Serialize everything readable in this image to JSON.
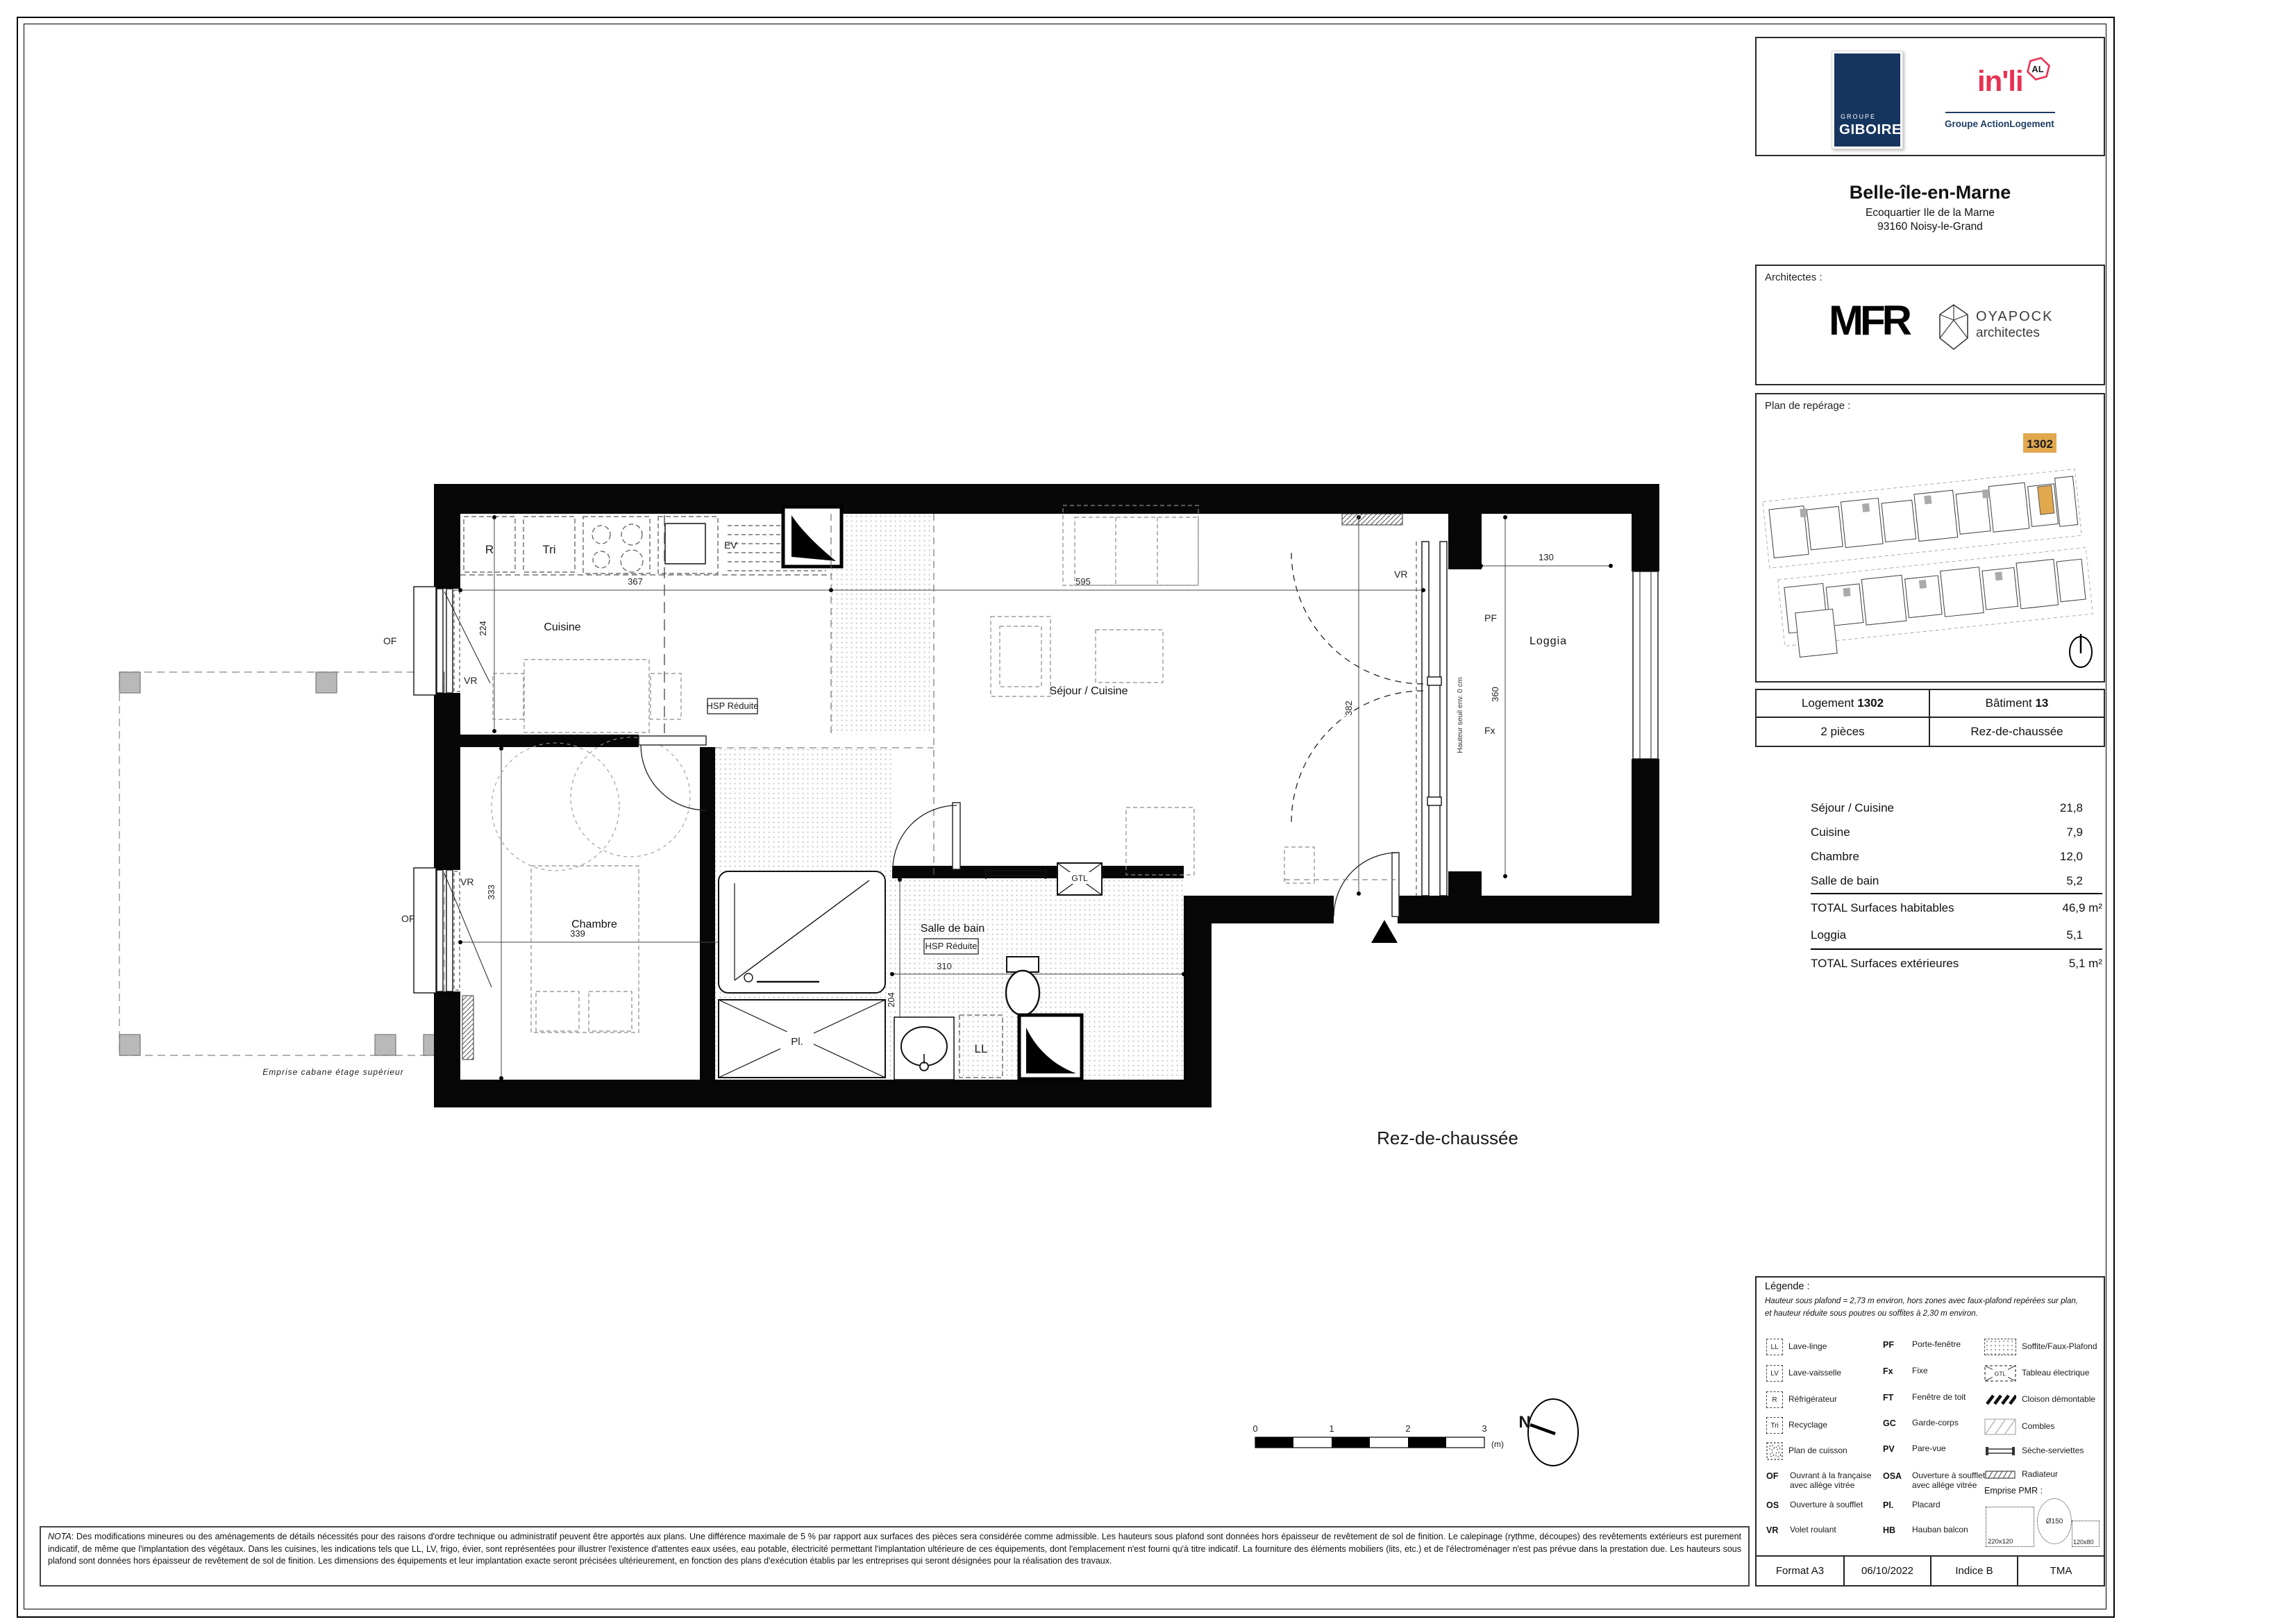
{
  "branding": {
    "giboire": {
      "top": "GROUPE",
      "name": "GIBOIRE"
    },
    "inli": {
      "name": "in'li",
      "badge": "AL",
      "group": "Groupe ActionLogement"
    }
  },
  "project": {
    "title": "Belle-île-en-Marne",
    "address1": "Ecoquartier Ile de la Marne",
    "address2": "93160 Noisy-le-Grand"
  },
  "architects": {
    "label": "Architectes :",
    "mfr": "MFR",
    "oyapock1": "OYAPOCK",
    "oyapock2": "architectes"
  },
  "reperage": {
    "title": "Plan de repérage :",
    "unit": "1302"
  },
  "unit": {
    "logement": "Logement",
    "logement_no": "1302",
    "batiment": "Bâtiment",
    "batiment_no": "13",
    "type": "2 pièces",
    "niveau": "Rez-de-chaussée"
  },
  "surfaces": {
    "rows": [
      {
        "label": "Séjour / Cuisine",
        "value": "21,8"
      },
      {
        "label": "Cuisine",
        "value": "7,9"
      },
      {
        "label": "Chambre",
        "value": "12,0"
      },
      {
        "label": "Salle de bain",
        "value": "5,2"
      }
    ],
    "total_hab_label": "TOTAL Surfaces habitables",
    "total_hab_value": "46,9 m²",
    "loggia_label": "Loggia",
    "loggia_value": "5,1",
    "total_ext_label": "TOTAL Surfaces extérieures",
    "total_ext_value": "5,1 m²"
  },
  "plan": {
    "floor": "Rez-de-chaussée",
    "rooms": {
      "cuisine": "Cuisine",
      "sejour": "Séjour / Cuisine",
      "chambre": "Chambre",
      "sdb": "Salle de bain",
      "loggia": "Loggia"
    },
    "dims": {
      "cuisine_w": "367",
      "cuisine_d": "224",
      "sejour_w": "595",
      "sejour_d": "382",
      "chambre_w": "339",
      "chambre_d": "333",
      "sdb_w": "310",
      "sdb_d": "204",
      "loggia_w": "130",
      "loggia_d": "360"
    },
    "tags": {
      "r": "R",
      "tri": "Tri",
      "ev": "EV",
      "vr": "VR",
      "of": "OF",
      "pf": "PF",
      "fx": "Fx",
      "gtl": "GTL",
      "ll": "LL",
      "pl": "Pl.",
      "hsp": "HSP Réduite",
      "seuil": "Hauteur seuil env. 0 cm",
      "emprise": "Emprise cabane étage supérieur"
    },
    "scalebar": {
      "t0": "0",
      "t1": "1",
      "t2": "2",
      "t3": "3",
      "unit": "(m)"
    },
    "north": "N"
  },
  "legend": {
    "title": "Légende :",
    "note1": "Hauteur sous plafond = 2,73 m environ, hors zones avec faux-plafond repérées sur plan,",
    "note2": "et hauteur réduite sous poutres ou soffites à 2,30 m environ.",
    "col1": [
      {
        "icon": "LL",
        "label": "Lave-linge"
      },
      {
        "icon": "LV",
        "label": "Lave-vaisselle"
      },
      {
        "icon": "R",
        "label": "Réfrigérateur"
      },
      {
        "icon": "Tri",
        "label": "Recyclage"
      },
      {
        "icon": "",
        "label": "Plan de cuisson"
      },
      {
        "icon": "OF",
        "label": "Ouvrant à la française avec allège vitrée"
      },
      {
        "icon": "OS",
        "label": "Ouverture à soufflet"
      },
      {
        "icon": "VR",
        "label": "Volet roulant"
      }
    ],
    "col2": [
      {
        "abbr": "PF",
        "label": "Porte-fenêtre"
      },
      {
        "abbr": "Fx",
        "label": "Fixe"
      },
      {
        "abbr": "FT",
        "label": "Fenêtre de toit"
      },
      {
        "abbr": "GC",
        "label": "Garde-corps"
      },
      {
        "abbr": "PV",
        "label": "Pare-vue"
      },
      {
        "abbr": "OSA",
        "label": "Ouverture à soufflet avec allège vitrée"
      },
      {
        "abbr": "Pl.",
        "label": "Placard"
      },
      {
        "abbr": "HB",
        "label": "Hauban balcon"
      }
    ],
    "col3": [
      {
        "label": "Soffite/Faux-Plafond"
      },
      {
        "label": "Tableau électrique"
      },
      {
        "label": "Cloison démontable"
      },
      {
        "label": "Combles"
      },
      {
        "label": "Sèche-serviettes"
      },
      {
        "label": "Radiateur"
      }
    ],
    "gtl_icon_text": "GTL",
    "pmr": {
      "label": "Emprise PMR :",
      "rect1": "220x120",
      "circle": "Ø150",
      "rect2": "120x80"
    }
  },
  "nota": {
    "label": "NOTA",
    "text": ": Des modifications mineures ou des aménagements de détails nécessités pour des raisons d'ordre technique ou administratif peuvent être apportés aux plans. Une différence maximale de 5 % par rapport aux surfaces des pièces sera considérée comme admissible. Les hauteurs sous plafond sont données hors épaisseur de revêtement de sol de finition. Le calepinage (rythme, découpes) des revêtements extérieurs est purement indicatif, de même que l'implantation des végétaux. Dans les cuisines, les indications tels que LL, LV, frigo, évier, sont représentées pour illustrer l'existence d'attentes eaux usées, eau potable, électricité permettant l'implantation ultérieure de ces équipements, dont l'emplacement n'est fourni qu'à titre indicatif. La fourniture des éléments mobiliers (lits, etc.) et de l'électroménager n'est pas prévue dans la prestation due. Les hauteurs sous plafond sont données hors épaisseur de revêtement de sol de finition. Les dimensions des équipements et leur implantation exacte seront précisées ultérieurement, en fonction des plans d'exécution établis par les entreprises qui seront désignées pour la réalisation des travaux."
  },
  "footer": {
    "format": "Format A3",
    "date": "06/10/2022",
    "indice": "Indice B",
    "tma": "TMA"
  }
}
